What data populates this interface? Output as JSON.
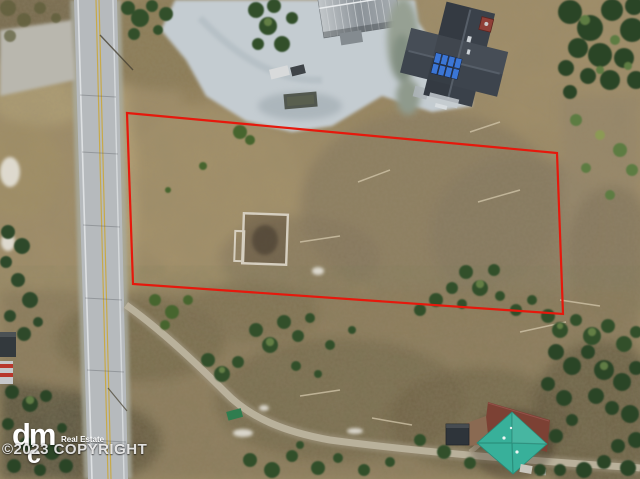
{
  "scene": {
    "type": "aerial-drone-photo",
    "subject": "vacant wooded land parcel outlined with red property boundary, beside a paved road, neighboring houses at top and bottom-right",
    "boundary_color": "#e6180c"
  },
  "logo": {
    "text": "dm",
    "mark": "c",
    "subtext": "Real Estate"
  },
  "watermark": {
    "copyright": "©2023 COPYRIGHT"
  }
}
